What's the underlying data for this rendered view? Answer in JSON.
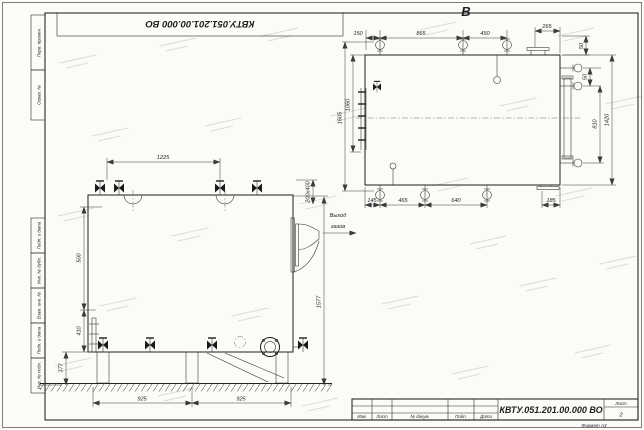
{
  "sheet": {
    "stamp_code": "КВТУ.051.201.00.000 ВО",
    "format_label": "Формат А3",
    "frame_labels": [
      "Перв. примен.",
      "Справ. №",
      "Подп. и дата",
      "Инв. № дубл.",
      "Взам. инв. №",
      "Подп. и дата",
      "Инв. № подл."
    ]
  },
  "title_block": {
    "code": "КВТУ.051.201.00.000 ВО",
    "cols": [
      "Изм.",
      "Лист",
      "№ докум.",
      "Подп.",
      "Дата"
    ],
    "sheet_label": "Лист",
    "sheet_number": "2"
  },
  "front_view": {
    "dims": {
      "top_width": "1225",
      "left_upper": "500",
      "left_mid": "410",
      "left_lower": "377",
      "bottom_left": "925",
      "bottom_right": "925",
      "right_height": "1577",
      "flue_size": "200х400"
    },
    "flue_note": [
      "Выход",
      "газов"
    ]
  },
  "top_view": {
    "view_label": "В",
    "dims": {
      "t1": "150",
      "t2": "865",
      "t3": "450",
      "t4": "265",
      "t5": "50",
      "r1": "50",
      "r2": "810",
      "r3": "1420",
      "l1": "1605",
      "l2": "1060",
      "b1": "145",
      "b2": "465",
      "b3": "640",
      "b4": "185"
    }
  }
}
